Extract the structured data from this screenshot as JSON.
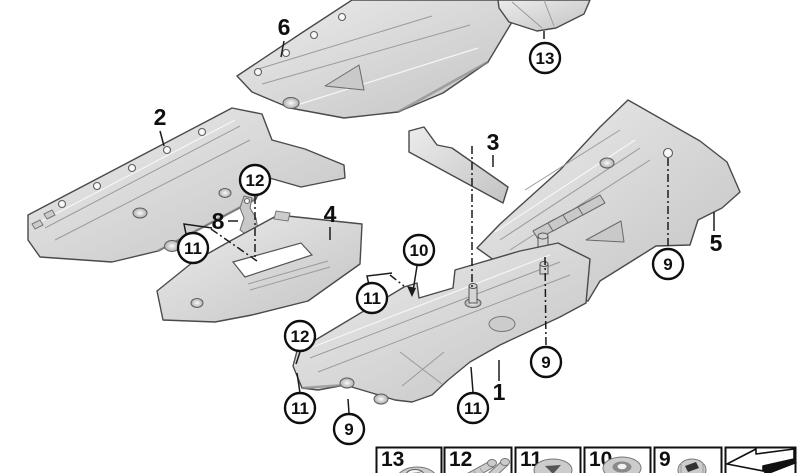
{
  "diagram": {
    "type": "exploded-parts-diagram",
    "background": "#ffffff",
    "line_color": "#1c1c1c",
    "panel_fill": "#d9d9d9",
    "panel_fill_light": "#ebebeb",
    "panel_fill_dark": "#b9b9b9"
  },
  "part_labels": [
    {
      "n": "6"
    },
    {
      "n": "2"
    },
    {
      "n": "3"
    },
    {
      "n": "8"
    },
    {
      "n": "4"
    },
    {
      "n": "5"
    },
    {
      "n": "1"
    }
  ],
  "callouts": [
    {
      "n": "13"
    },
    {
      "n": "12"
    },
    {
      "n": "11"
    },
    {
      "n": "10"
    },
    {
      "n": "11"
    },
    {
      "n": "9"
    },
    {
      "n": "12"
    },
    {
      "n": "9"
    },
    {
      "n": "11"
    },
    {
      "n": "11"
    },
    {
      "n": "9"
    }
  ],
  "legend": {
    "items": [
      {
        "n": "13",
        "icon": "washer-icon"
      },
      {
        "n": "12",
        "icon": "screw-set-icon"
      },
      {
        "n": "11",
        "icon": "expansion-rivet-icon"
      },
      {
        "n": "10",
        "icon": "grommet-icon"
      },
      {
        "n": "9",
        "icon": "cap-nut-icon"
      }
    ],
    "arrow_icon": "continuation-arrow-icon"
  }
}
